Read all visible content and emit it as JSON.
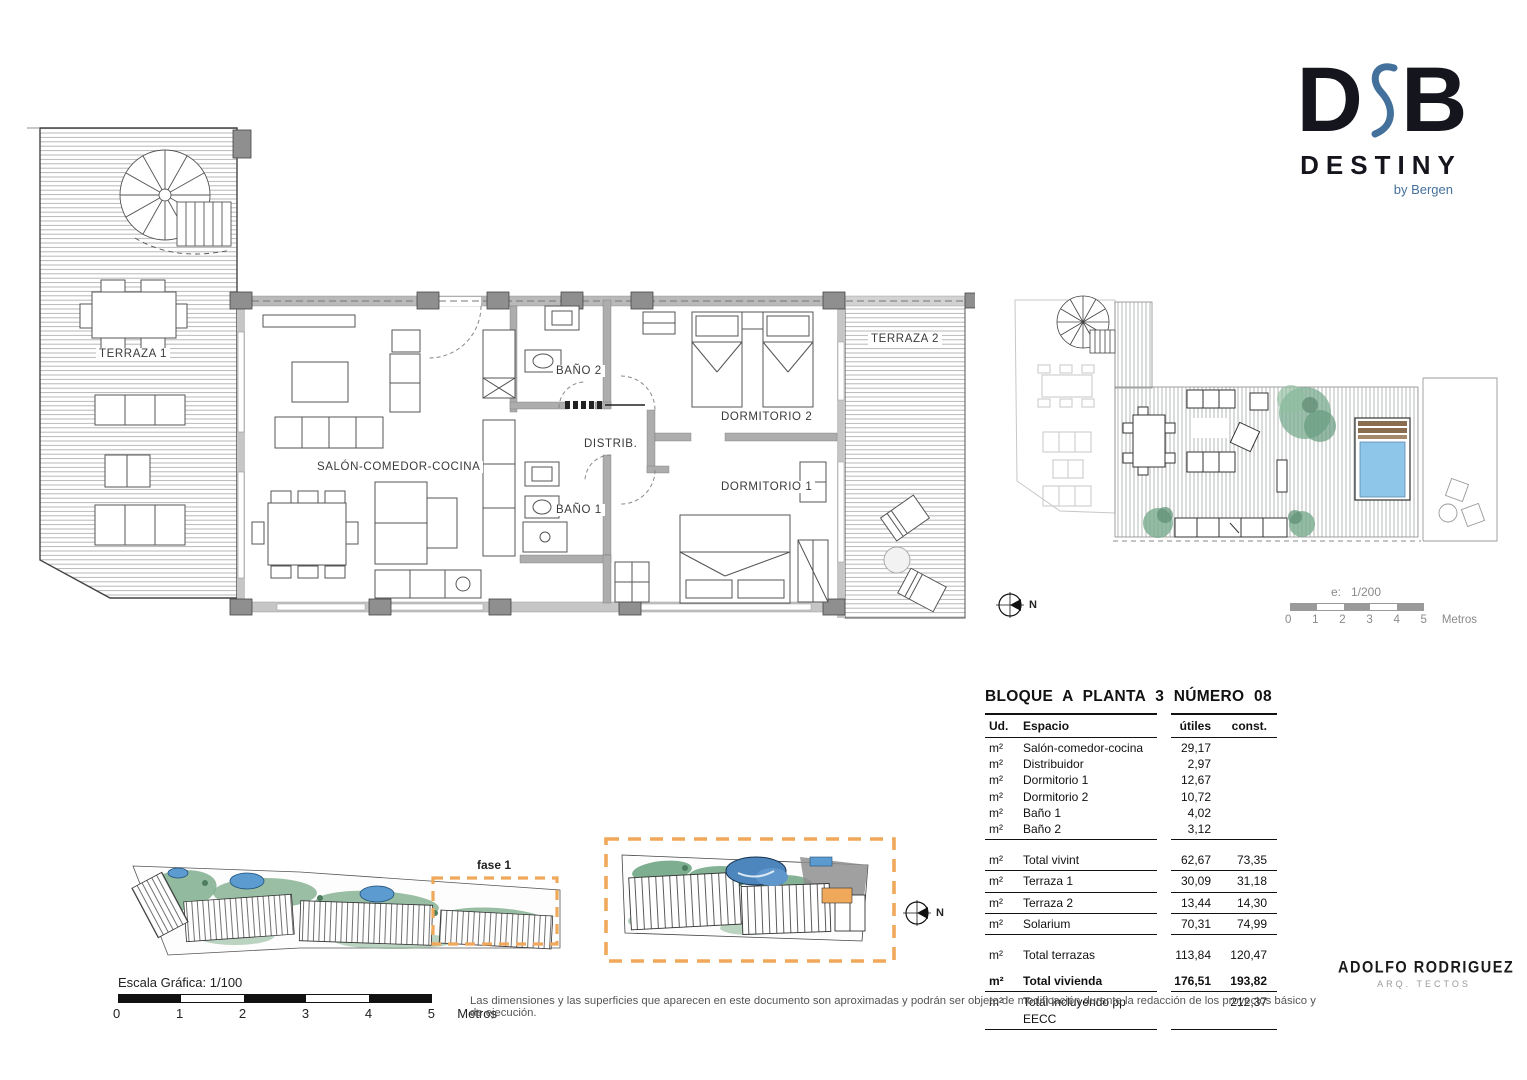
{
  "logo": {
    "letter_d": "D",
    "letter_b": "B",
    "wordmark": "DESTINY",
    "byline": "by Bergen",
    "accent_color": "#44719b"
  },
  "plan": {
    "rooms": {
      "terraza1": "TERRAZA 1",
      "salon": "SALÓN-COMEDOR-COCINA",
      "bano2": "BAÑO 2",
      "distrib": "DISTRIB.",
      "bano1": "BAÑO 1",
      "dorm2": "DORMITORIO 2",
      "dorm1": "DORMITORIO 1",
      "terraza2": "TERRAZA 2"
    }
  },
  "site": {
    "fase_label": "fase 1",
    "highlight_color": "#f0a85a"
  },
  "compass": {
    "label": "N"
  },
  "scale_main": {
    "label": "Escala Gráfica:  1/100",
    "ticks": [
      "0",
      "1",
      "2",
      "3",
      "4",
      "5"
    ],
    "unit": "Metros"
  },
  "scale_solarium": {
    "label_e": "e:",
    "ratio": "1/200",
    "ticks": [
      "0",
      "1",
      "2",
      "3",
      "4",
      "5"
    ],
    "unit": "Metros"
  },
  "table": {
    "title": "BLOQUE A  PLANTA 3  NÚMERO 08",
    "headers": {
      "ud": "Ud.",
      "espacio": "Espacio",
      "utiles": "útiles",
      "const": "const."
    },
    "rows": [
      {
        "ud": "m²",
        "espacio": "Salón-comedor-cocina",
        "utiles": "29,17",
        "const": ""
      },
      {
        "ud": "m²",
        "espacio": "Distribuidor",
        "utiles": "2,97",
        "const": ""
      },
      {
        "ud": "m²",
        "espacio": "Dormitorio 1",
        "utiles": "12,67",
        "const": ""
      },
      {
        "ud": "m²",
        "espacio": "Dormitorio 2",
        "utiles": "10,72",
        "const": ""
      },
      {
        "ud": "m²",
        "espacio": "Baño 1",
        "utiles": "4,02",
        "const": ""
      },
      {
        "ud": "m²",
        "espacio": "Baño 2",
        "utiles": "3,12",
        "const": ""
      },
      {
        "ud": "m²",
        "espacio": "Total vivint",
        "utiles": "62,67",
        "const": "73,35"
      },
      {
        "ud": "m²",
        "espacio": "Terraza 1",
        "utiles": "30,09",
        "const": "31,18"
      },
      {
        "ud": "m²",
        "espacio": "Terraza 2",
        "utiles": "13,44",
        "const": "14,30"
      },
      {
        "ud": "m²",
        "espacio": "Solarium",
        "utiles": "70,31",
        "const": "74,99"
      },
      {
        "ud": "m²",
        "espacio": "Total terrazas",
        "utiles": "113,84",
        "const": "120,47"
      },
      {
        "ud": "m²",
        "espacio": "Total vivienda",
        "utiles": "176,51",
        "const": "193,82"
      },
      {
        "ud": "m²",
        "espacio": "Total incluyendo pp EECC",
        "utiles": "",
        "const": "212,37"
      }
    ]
  },
  "disclaimer": "Las dimensiones y las superficies que aparecen en este documento son aproximadas y podrán ser objeto de modificación durante la redacción de los proyectos básico y de ejecución.",
  "architect": {
    "name": "ADOLFO RODRIGUEZ",
    "subtitle": "ARQ. TECTOS"
  }
}
